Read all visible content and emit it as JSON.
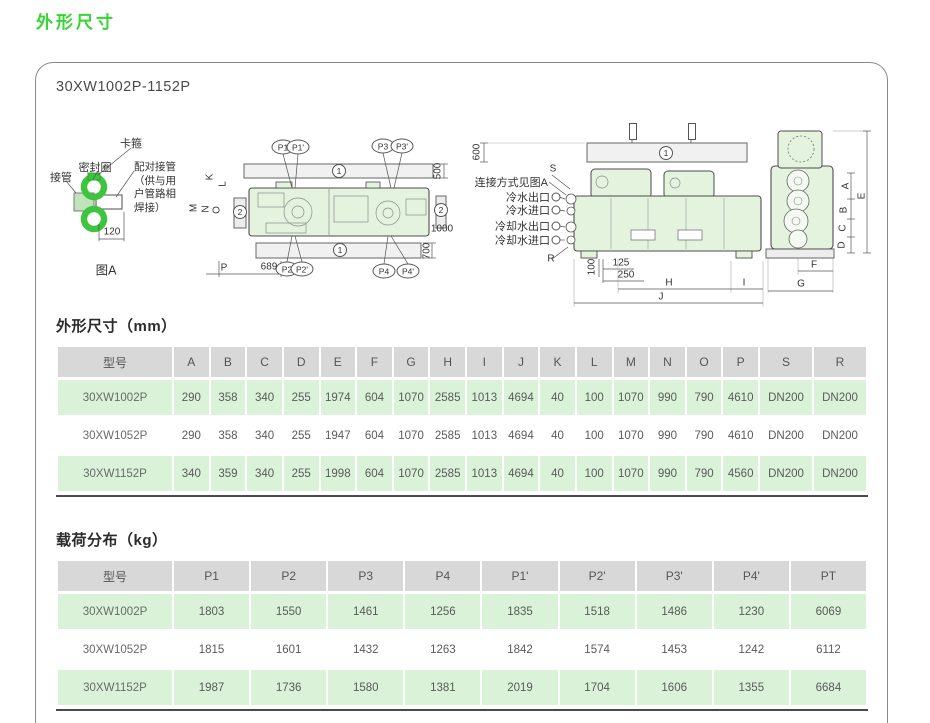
{
  "page_title": "外形尺寸",
  "panel": {
    "model_range": "30XW1002P-1152P"
  },
  "fig_a": {
    "caption": "图A",
    "dim_120": "120",
    "labels": {
      "pipe": "接管",
      "seal": "密封圈",
      "clamp": "卡箍",
      "mating": "配对接管\n（供与用\n户管路相\n焊接）"
    }
  },
  "markers": {
    "rail": "1",
    "pad": "2"
  },
  "top_view": {
    "callouts": {
      "p1": "P1",
      "p1p": "P1'",
      "p2": "P2",
      "p2p": "P2'",
      "p3": "P3",
      "p3p": "P3'",
      "p4": "P4",
      "p4p": "P4'"
    },
    "dims": {
      "d500": "500",
      "d1000": "1000",
      "d700": "700",
      "d689": "689"
    },
    "letters": {
      "k": "K",
      "l": "L",
      "m": "M",
      "n": "N",
      "o": "O",
      "p": "P"
    }
  },
  "side_view": {
    "dims": {
      "d600": "600",
      "d100": "100",
      "d125": "125",
      "d250": "250"
    },
    "letters": {
      "s": "S",
      "r": "R",
      "h": "H",
      "i": "I",
      "j": "J"
    },
    "labels": {
      "connection": "连接方式见图A",
      "chw_out": "冷水出口",
      "chw_in": "冷水进口",
      "cw_out": "冷却水出口",
      "cw_in": "冷却水进口"
    }
  },
  "end_view": {
    "letters": {
      "a": "A",
      "b": "B",
      "c": "C",
      "d": "D",
      "e": "E",
      "f": "F",
      "g": "G"
    }
  },
  "dim_table": {
    "title": "外形尺寸（mm）",
    "columns": [
      "型号",
      "A",
      "B",
      "C",
      "D",
      "E",
      "F",
      "G",
      "H",
      "I",
      "J",
      "K",
      "L",
      "M",
      "N",
      "O",
      "P",
      "S",
      "R"
    ],
    "rows": [
      [
        "30XW1002P",
        "290",
        "358",
        "340",
        "255",
        "1974",
        "604",
        "1070",
        "2585",
        "1013",
        "4694",
        "40",
        "100",
        "1070",
        "990",
        "790",
        "4610",
        "DN200",
        "DN200"
      ],
      [
        "30XW1052P",
        "290",
        "358",
        "340",
        "255",
        "1947",
        "604",
        "1070",
        "2585",
        "1013",
        "4694",
        "40",
        "100",
        "1070",
        "990",
        "790",
        "4610",
        "DN200",
        "DN200"
      ],
      [
        "30XW1152P",
        "340",
        "359",
        "340",
        "255",
        "1998",
        "604",
        "1070",
        "2585",
        "1013",
        "4694",
        "40",
        "100",
        "1070",
        "990",
        "790",
        "4560",
        "DN200",
        "DN200"
      ]
    ]
  },
  "load_table": {
    "title": "载荷分布（kg）",
    "columns": [
      "型号",
      "P1",
      "P2",
      "P3",
      "P4",
      "P1'",
      "P2'",
      "P3'",
      "P4'",
      "PT"
    ],
    "rows": [
      [
        "30XW1002P",
        "1803",
        "1550",
        "1461",
        "1256",
        "1835",
        "1518",
        "1486",
        "1230",
        "6069"
      ],
      [
        "30XW1052P",
        "1815",
        "1601",
        "1432",
        "1263",
        "1842",
        "1574",
        "1453",
        "1242",
        "6112"
      ],
      [
        "30XW1152P",
        "1987",
        "1736",
        "1580",
        "1381",
        "2019",
        "1704",
        "1606",
        "1355",
        "6684"
      ]
    ]
  },
  "colors": {
    "title_green": "#33d633",
    "row_green": "#d9f2d8",
    "header_grey": "#d8d8d8",
    "machine_fill": "#e3f3de",
    "clamp_green": "#3fc43f"
  }
}
